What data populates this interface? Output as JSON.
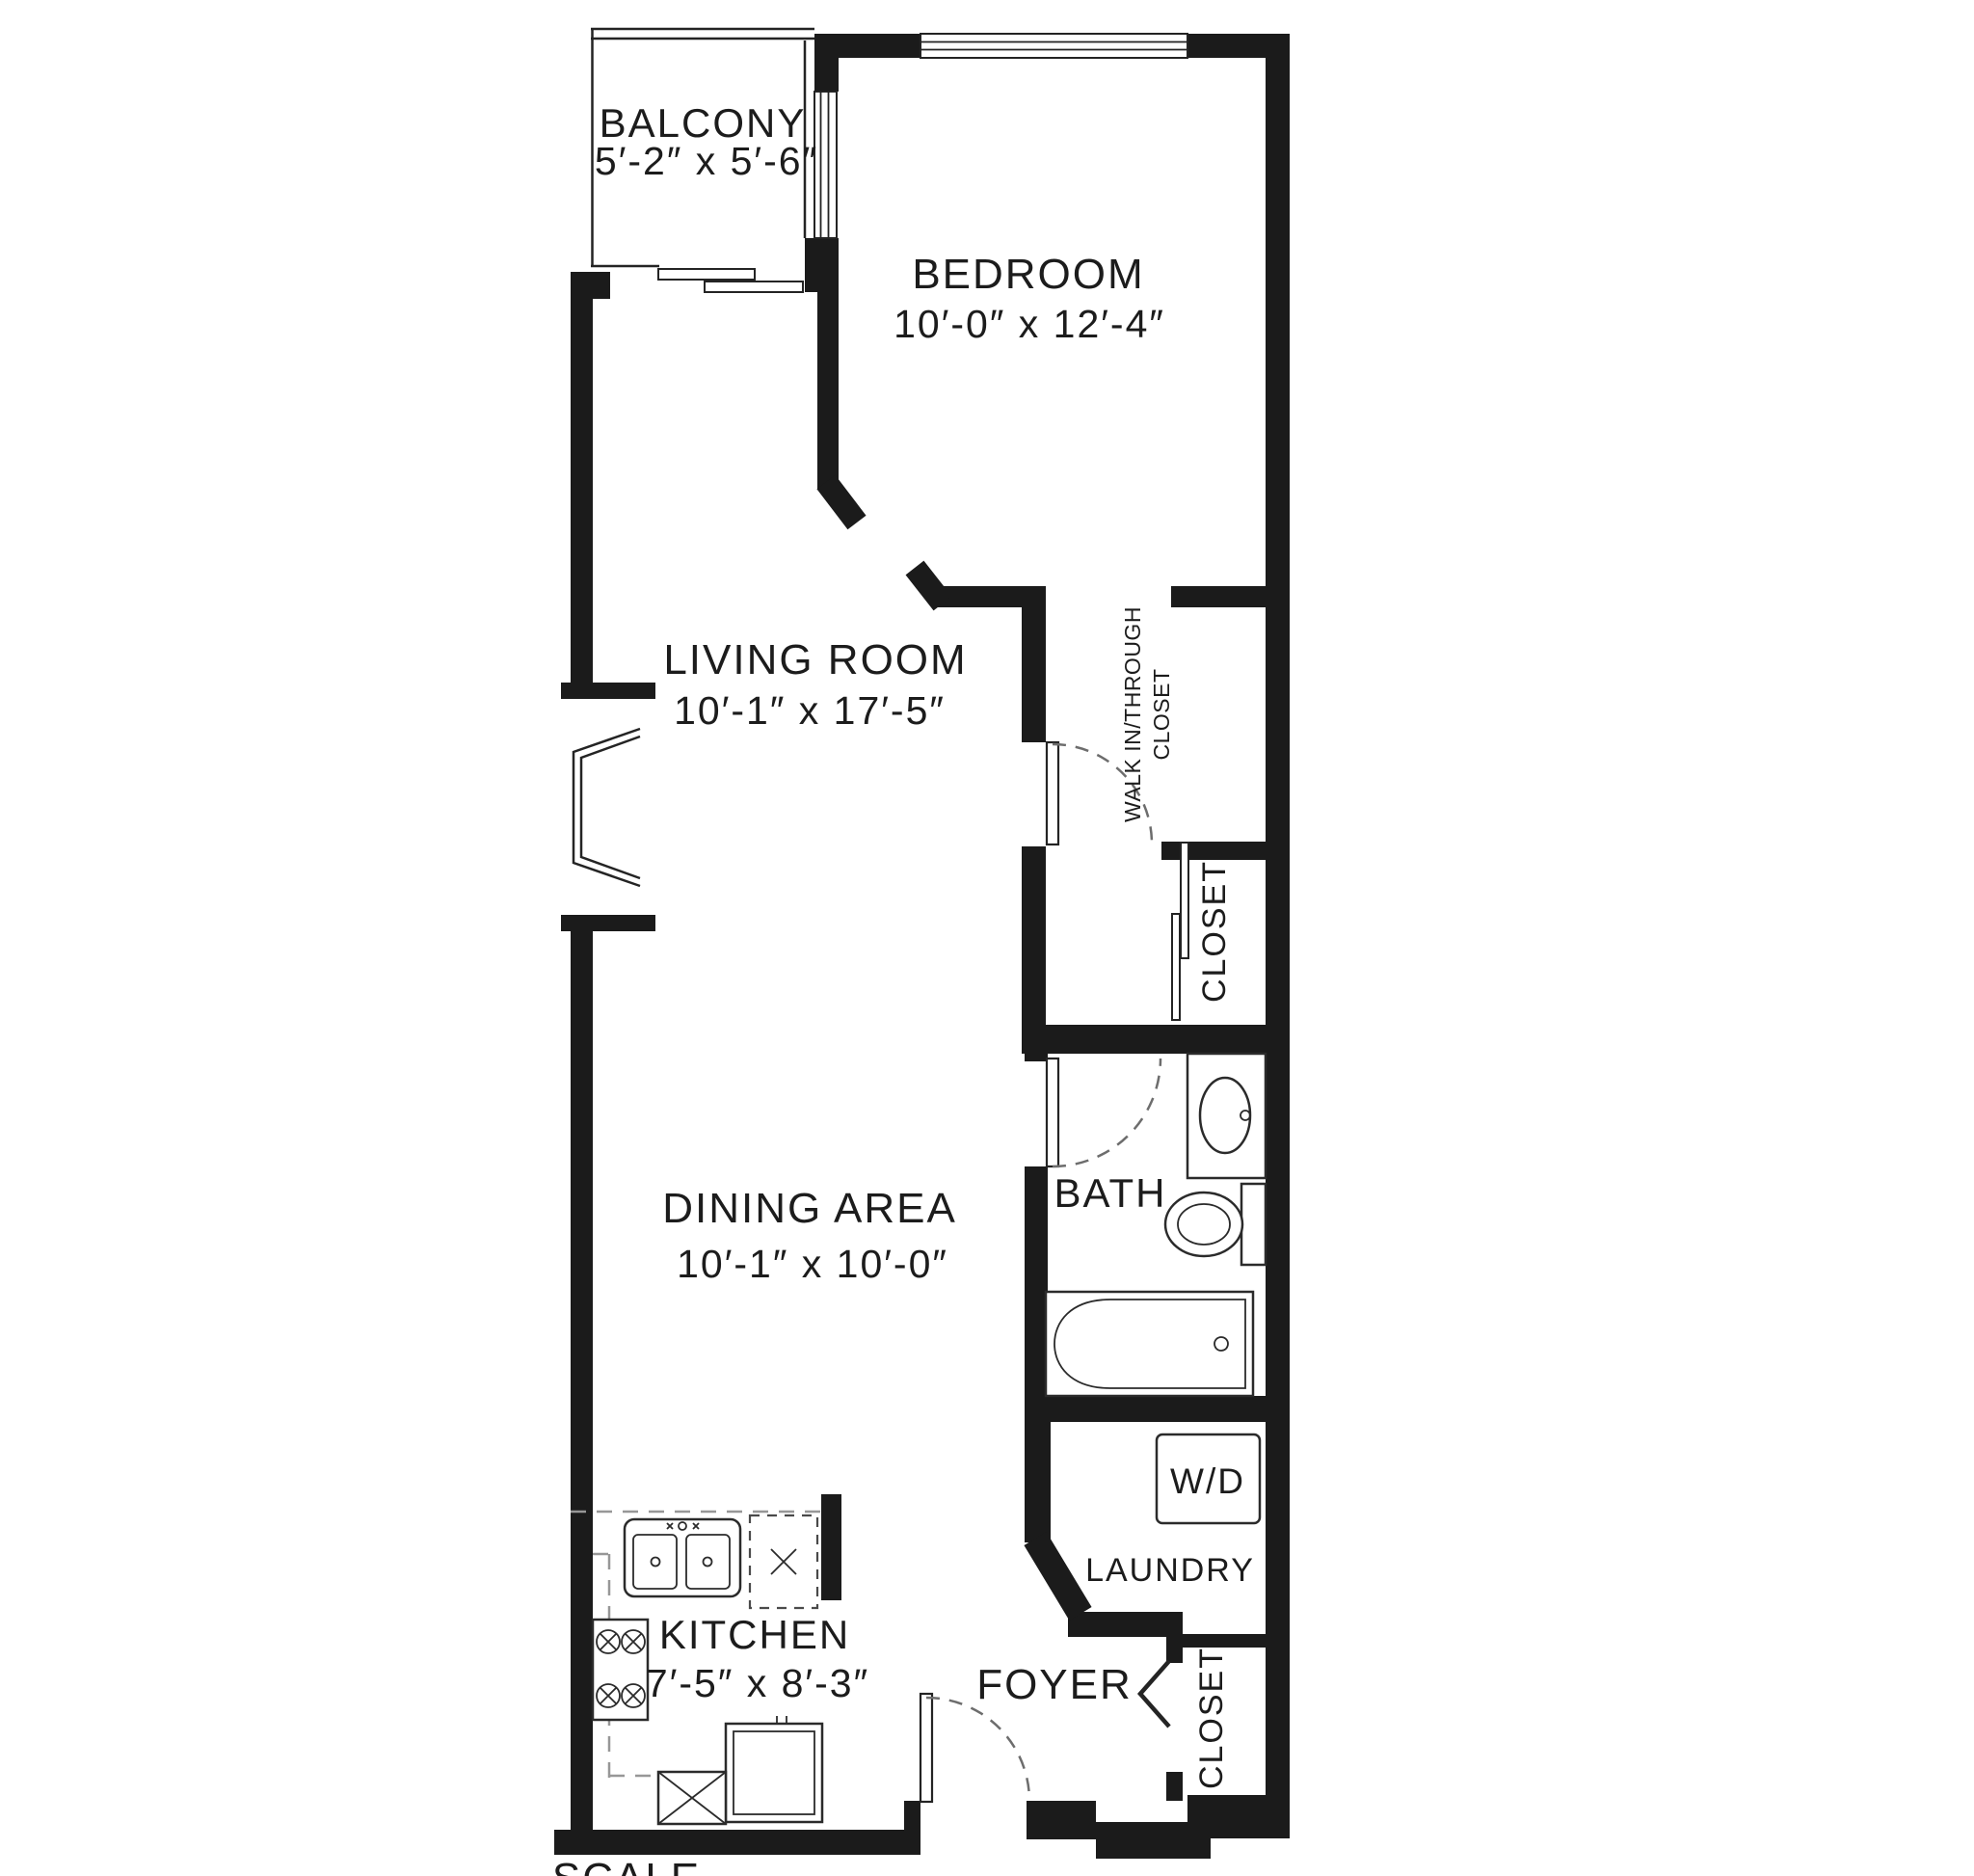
{
  "plan": {
    "background": "#ffffff",
    "wall_color": "#1b1b1b",
    "line_color": "#2b2b2b",
    "dash_color": "#979797",
    "text_color": "#1c1c1c",
    "rooms": {
      "balcony": {
        "label": "BALCONY",
        "dims": "5′-2″ x 5′-6″"
      },
      "bedroom": {
        "label": "BEDROOM",
        "dims": "10′-0″ x 12′-4″"
      },
      "living_room": {
        "label": "LIVING ROOM",
        "dims": "10′-1″ x 17′-5″"
      },
      "dining_area": {
        "label": "DINING AREA",
        "dims": "10′-1″ x 10′-0″"
      },
      "kitchen": {
        "label": "KITCHEN",
        "dims": "7′-5″ x 8′-3″"
      },
      "bath": {
        "label": "BATH"
      },
      "foyer": {
        "label": "FOYER"
      },
      "laundry": {
        "label": "LAUNDRY"
      },
      "walk_in_closet": {
        "line1": "WALK IN/THROUGH",
        "line2": "CLOSET"
      },
      "bedroom_closet": {
        "label": "CLOSET"
      },
      "foyer_closet": {
        "label": "CLOSET"
      },
      "washer_dryer": {
        "label": "W/D"
      }
    },
    "footer": {
      "scale_label": "SCALE"
    }
  }
}
